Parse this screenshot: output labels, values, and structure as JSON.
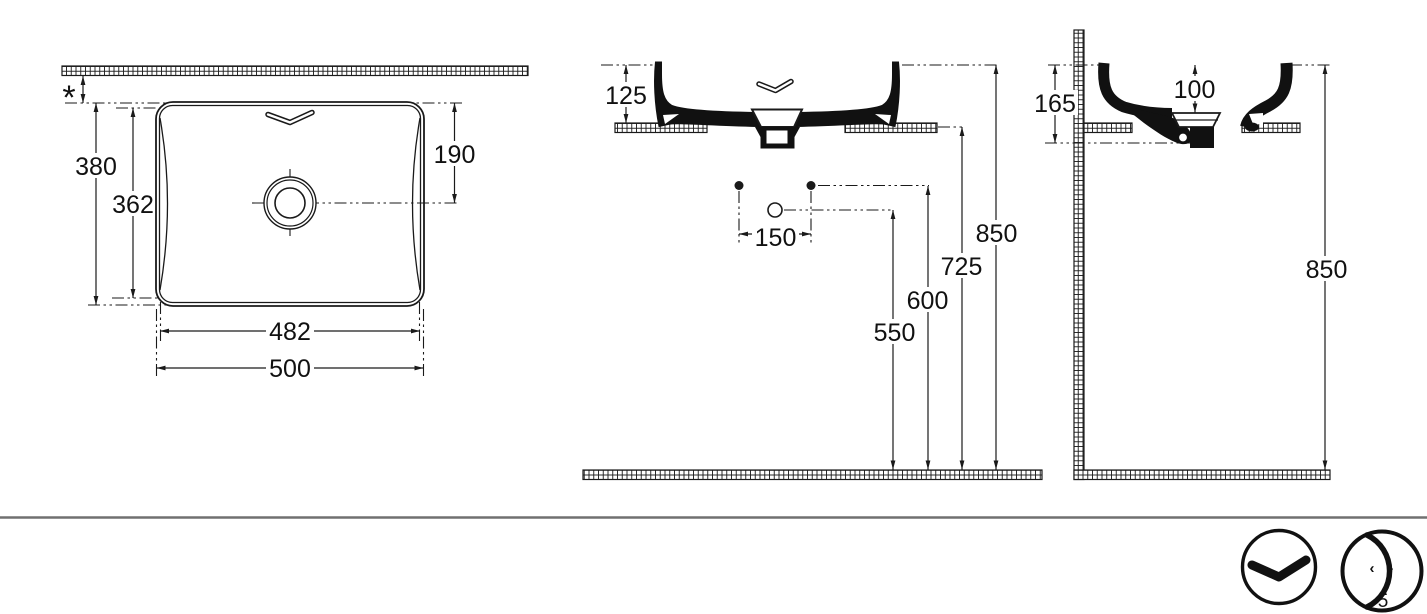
{
  "views": {
    "top": {
      "wall_clearance": "*",
      "depth_overall": "380",
      "depth_inner": "362",
      "drain_from_rim": "190",
      "width_inner": "482",
      "width_overall": "500"
    },
    "front": {
      "height_above_counter": "125",
      "hole_spacing": "150",
      "drain_outlet_height": "550",
      "supply_height": "600",
      "counter_height": "725",
      "rim_height": "850"
    },
    "side": {
      "height_total": "165",
      "bowl_depth": "100",
      "rim_height": "850"
    }
  },
  "footer": {
    "badge_left_arrow": "‹",
    "badge_right_arrow": "›",
    "badge_number": "5"
  },
  "icons": {
    "badge1": "wave-chevron-icon",
    "badge2": "crescent-depth-icon"
  },
  "colors": {
    "line": "#1a1a1a",
    "separator": "#707070",
    "background": "#ffffff"
  }
}
